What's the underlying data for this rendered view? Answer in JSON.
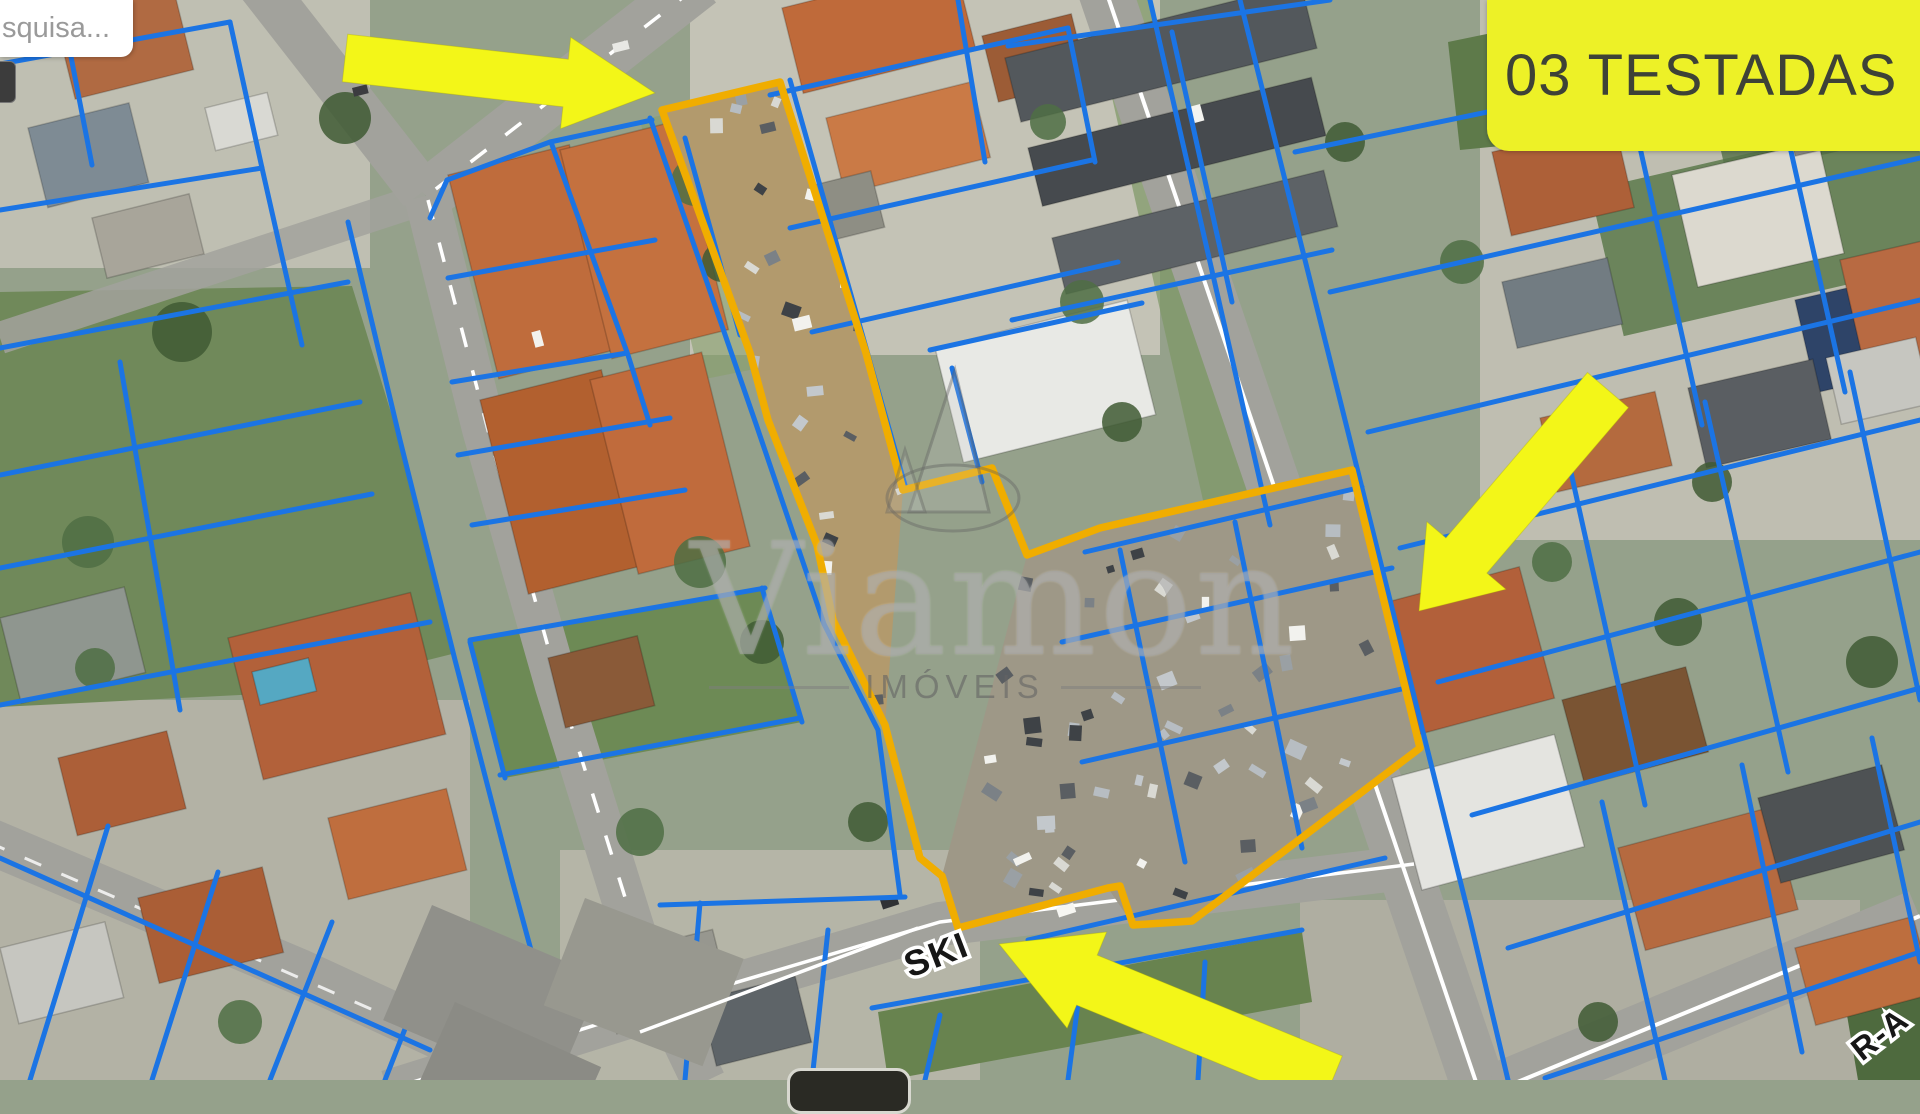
{
  "search": {
    "visible_text": "squisa..."
  },
  "banner": {
    "label": "03 TESTADAS"
  },
  "watermark": {
    "brand": "Viamon",
    "subtitle": "IMÓVEIS",
    "logo": "sailboat-logo-icon"
  },
  "map": {
    "street_labels": [
      {
        "text": "SKI"
      },
      {
        "text": "R-A"
      }
    ],
    "annotations": {
      "property_outline": {
        "points": "662,110 780,82 866,353 903,490 992,468 1027,555 1100,528 1352,470 1420,748 1192,921 1133,925 1120,886 1108,888 958,928 942,876 920,858 885,725 833,620 817,545 768,420 750,353"
      },
      "arrows": [
        {
          "icon": "arrow-right-icon",
          "points": "347.7,34.2 568.3,59.2 570.7,37.3 655,93 560.5,128.7 562.9,106.8 342.3,81.8"
        },
        {
          "icon": "arrow-down-left-icon",
          "points": "1587.5,372.5 1445.9,537.9 1426.9,521.7 1419,611 1505.9,589.3 1486.9,573.1 1628.5,407.6"
        },
        {
          "icon": "arrow-up-left-icon",
          "points": "1342.3,1056 1097.2,955.1 1106.7,932 999,944 1067.1,1028.2 1076.6,1005.1 1321.7,1106"
        }
      ]
    }
  },
  "colors": {
    "parcel_line_blue": "#1B74E4",
    "property_outline_gold": "#F0AD00",
    "arrow_yellow": "#F3F618",
    "banner_bg": "#EDF127",
    "banner_text": "#3E4237",
    "watermark_gray": "#8f8f8f"
  }
}
